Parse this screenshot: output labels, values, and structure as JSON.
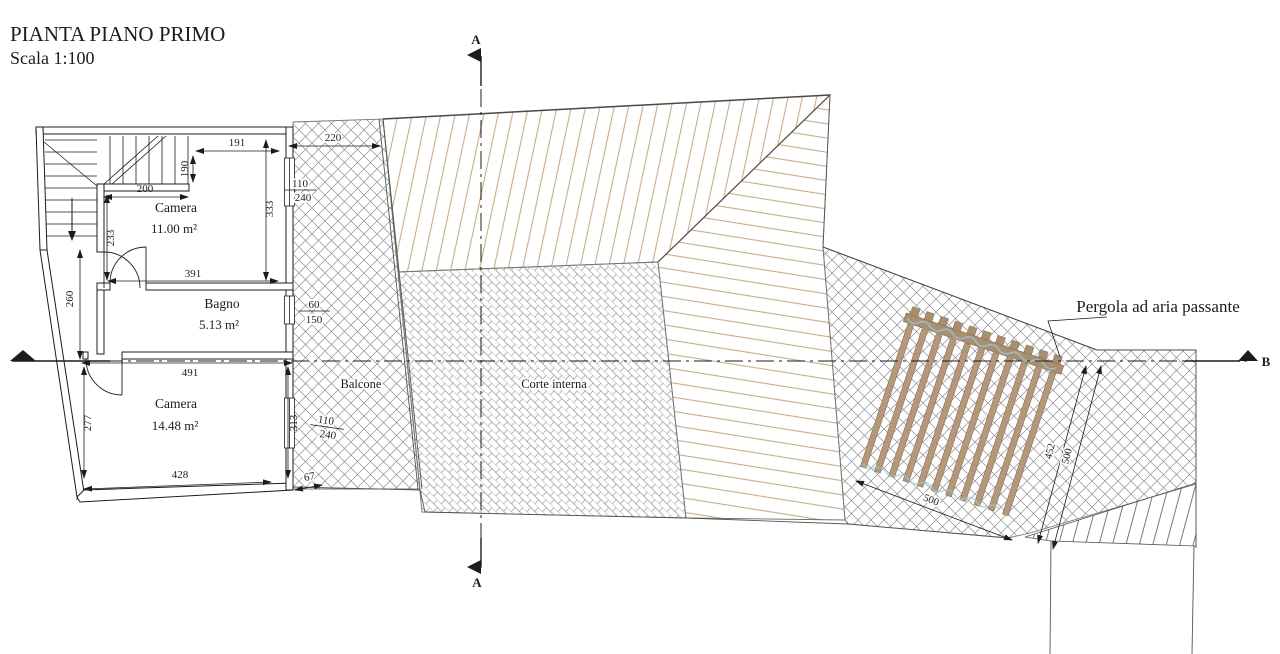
{
  "title": {
    "main": "PIANTA PIANO PRIMO",
    "scale": "Scala 1:100"
  },
  "section_markers": {
    "top": "A",
    "bottom": "A",
    "right": "B"
  },
  "rooms": {
    "camera1": {
      "name": "Camera",
      "area": "11.00 m²"
    },
    "bagno": {
      "name": "Bagno",
      "area": "5.13 m²"
    },
    "camera2": {
      "name": "Camera",
      "area": "14.48 m²"
    }
  },
  "areas": {
    "balcone": "Balcone",
    "corte": "Corte interna"
  },
  "annotations": {
    "pergola": "Pergola ad aria passante"
  },
  "dimensions": {
    "d191": "191",
    "d190": "190",
    "d200": "200",
    "d220": "220",
    "d333": "333",
    "d233": "233",
    "d391": "391",
    "d260": "260",
    "d491": "491",
    "d277": "277",
    "d313": "313",
    "d428": "428",
    "d67": "67",
    "d500_bottom": "500",
    "d452": "452",
    "d500_right": "500"
  },
  "windows": {
    "w1": {
      "num": "110",
      "den": "240"
    },
    "w2": {
      "num": "60",
      "den": "150"
    },
    "w3": {
      "num": "110",
      "den": "240"
    }
  },
  "colors": {
    "roof_hatch": "#c8ac8a",
    "pergola_wood": "#b3987a",
    "pergola_beam": "#a8906f",
    "hatch_gray": "#8f8f8f",
    "line": "#1c1c1c",
    "accent_blue": "#9cc4d6"
  }
}
